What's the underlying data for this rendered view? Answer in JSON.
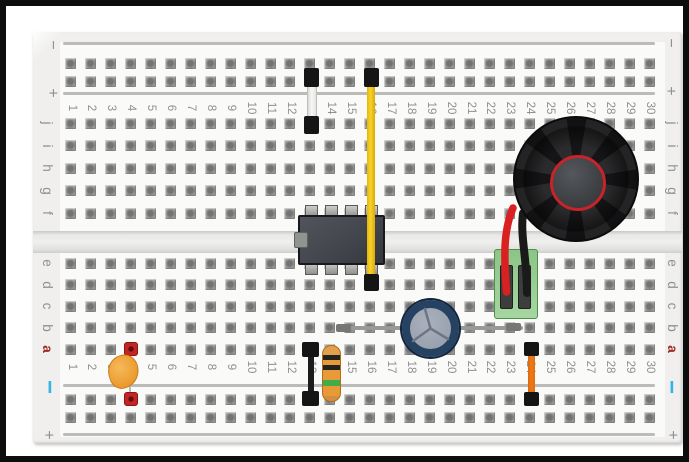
{
  "title": "breadboard circuit diagram (555 timer tone generator with speaker)",
  "board": {
    "column_numbers": [
      "1",
      "2",
      "3",
      "4",
      "5",
      "6",
      "7",
      "8",
      "9",
      "10",
      "11",
      "12",
      "13",
      "14",
      "15",
      "16",
      "17",
      "18",
      "19",
      "20",
      "21",
      "22",
      "23",
      "24",
      "25",
      "26",
      "27",
      "28",
      "29",
      "30"
    ],
    "row_labels_top": [
      "j",
      "i",
      "h",
      "g",
      "f"
    ],
    "row_labels_bottom": [
      "e",
      "d",
      "c",
      "b",
      "a"
    ],
    "rail_markers": {
      "minus": "−",
      "plus": "+"
    }
  },
  "colors": {
    "wire_white": "#f3f3f1",
    "wire_yellow": "#e5b60d",
    "wire_black": "#1c1c1c",
    "wire_orange": "#f07818",
    "wire_red": "#d92121",
    "wire_gray": "#999997",
    "ic_body": "#43464e",
    "speaker_body": "#151517",
    "speaker_ring": "#c8232a",
    "cap_ring": "#264263",
    "cap_center": "#9aa2af",
    "terminal_green": "#96c892",
    "resistor_body": "#e89a36",
    "resistor_band_black": "#222220",
    "resistor_band_green": "#3fae49",
    "disc_cap_orange": "#eb9a2e",
    "pad_red": "#c32424",
    "rail_minus_cyan": "#35b5e5",
    "label_gray": "#909090",
    "label_red": "#9c2b21"
  },
  "components": [
    {
      "name": "jumper-wire-white",
      "type": "jumper wire",
      "color_key": "wire_white",
      "from": "top positive rail column 13",
      "to": "row j column 13"
    },
    {
      "name": "jumper-wire-yellow",
      "type": "jumper wire",
      "color_key": "wire_yellow",
      "from": "top positive rail column 16",
      "to": "row d column 16"
    },
    {
      "name": "ic-8pin-dip",
      "type": "8-pin DIP IC (555 timer)",
      "color_key": "ic_body",
      "location": "columns 13-16 straddling center channel"
    },
    {
      "name": "speaker",
      "type": "round speaker",
      "color_key": "speaker_body",
      "location": "columns 24-29, rows f-j"
    },
    {
      "name": "terminal-block",
      "type": "2-pin terminal block",
      "color_key": "terminal_green",
      "location": "columns 23-24, rows c-e"
    },
    {
      "name": "speaker-wire-red",
      "type": "wire",
      "color_key": "wire_red",
      "from": "speaker",
      "to": "terminal block pin column 23"
    },
    {
      "name": "speaker-wire-black",
      "type": "wire",
      "color_key": "wire_black",
      "from": "speaker",
      "to": "terminal block pin column 24"
    },
    {
      "name": "electrolytic-capacitor",
      "type": "electrolytic capacitor (top view)",
      "color_key": "cap_ring",
      "location": "row b, column 19"
    },
    {
      "name": "bare-wire-gray",
      "type": "wire",
      "color_key": "wire_gray",
      "from": "row b column 15",
      "to": "row b column 23"
    },
    {
      "name": "jumper-wire-black",
      "type": "jumper wire",
      "color_key": "wire_black",
      "from": "row a column 13",
      "to": "bottom negative rail column 13"
    },
    {
      "name": "resistor",
      "type": "resistor (orange body, black/black/green bands)",
      "color_key": "resistor_body",
      "from": "row a column 14",
      "to": "bottom negative rail column 14"
    },
    {
      "name": "disc-capacitor-orange",
      "type": "disc capacitor",
      "color_key": "disc_cap_orange",
      "from": "row a column 4",
      "to": "bottom negative rail column 4"
    },
    {
      "name": "jumper-wire-orange",
      "type": "jumper wire",
      "color_key": "wire_orange",
      "from": "row a column 24",
      "to": "bottom negative rail column 24"
    }
  ]
}
